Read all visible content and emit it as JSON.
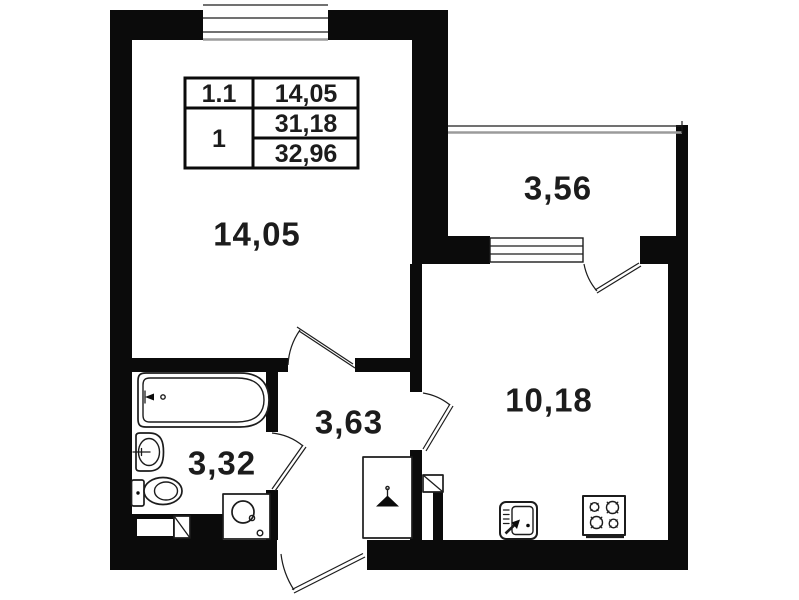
{
  "floor_plan": {
    "info_table": {
      "unit_label": "1.1",
      "living_area": "14,05",
      "rooms_count": "1",
      "total_area": "31,18",
      "total_area_with_balcony": "32,96"
    },
    "rooms": {
      "living_room": {
        "area": "14,05"
      },
      "balcony": {
        "area": "3,56"
      },
      "kitchen": {
        "area": "10,18"
      },
      "hallway": {
        "area": "3,63"
      },
      "bathroom": {
        "area": "3,32"
      }
    },
    "fixtures": [
      "bathtub-icon",
      "wash-basin-icon",
      "toilet-icon",
      "washing-machine-icon",
      "hanger-icon",
      "vent-shaft-icon",
      "kitchen-sink-icon",
      "stove-icon",
      "window-icon",
      "balcony-railing-icon",
      "door-arc-icon"
    ],
    "colors": {
      "wall": "#0b0b0b",
      "line": "#1c1c1c",
      "background": "#ffffff",
      "window_gray": "#9b9b9b"
    }
  }
}
